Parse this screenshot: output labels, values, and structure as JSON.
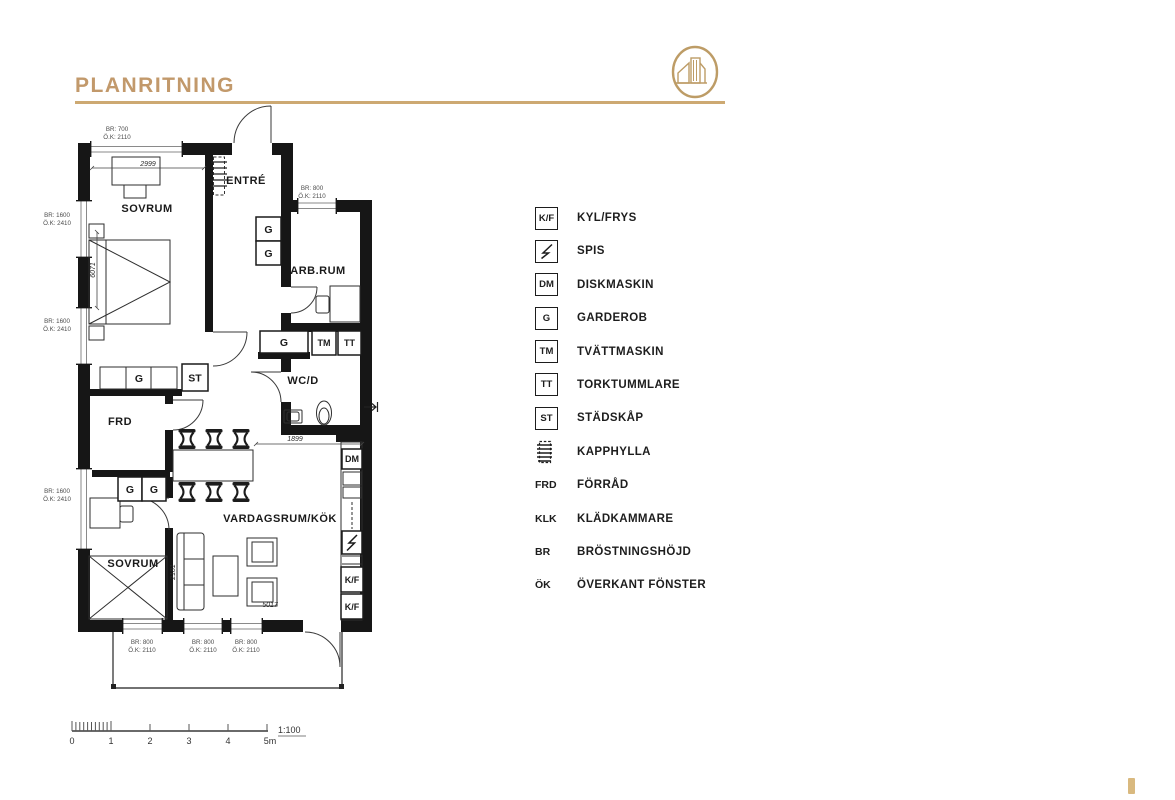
{
  "header": {
    "title": "PLANRITNING",
    "accent_color": "#C2996B",
    "rule_color": "#CDA972"
  },
  "floorplan": {
    "rooms": [
      {
        "id": "sovrum-1",
        "label": "SOVRUM"
      },
      {
        "id": "entre",
        "label": "ENTRÉ"
      },
      {
        "id": "arbrum",
        "label": "ARB.RUM"
      },
      {
        "id": "wcd",
        "label": "WC/D"
      },
      {
        "id": "frd",
        "label": "FRD"
      },
      {
        "id": "sovrum-2",
        "label": "SOVRUM"
      },
      {
        "id": "vardagsrum-kok",
        "label": "VARDAGSRUM/KÖK"
      }
    ],
    "fixtures": {
      "hall_g_1": "G",
      "hall_g_2": "G",
      "stadskap": "ST",
      "wardrobe_g": "G",
      "wc_g": "G",
      "tvattmaskin": "TM",
      "torktumlare": "TT",
      "diskmaskin": "DM",
      "kyl_frys_1": "K/F",
      "kyl_frys_2": "K/F",
      "sovrum2_g_1": "G",
      "sovrum2_g_2": "G"
    },
    "dimensions": {
      "top_width": "2999",
      "left_height": "6071",
      "wc_width": "1899",
      "sofa_depth": "2181",
      "bottom_width": "5017"
    },
    "window_labels": [
      {
        "id": "top",
        "br": "BR: 700",
        "ok": "Ö.K: 2110"
      },
      {
        "id": "arbrum",
        "br": "BR: 800",
        "ok": "Ö.K: 2110"
      },
      {
        "id": "left-upper",
        "br": "BR: 1600",
        "ok": "Ö.K: 2410"
      },
      {
        "id": "left-middle",
        "br": "BR: 1600",
        "ok": "Ö.K: 2410"
      },
      {
        "id": "left-lower",
        "br": "BR: 1600",
        "ok": "Ö.K: 2410"
      },
      {
        "id": "bottom-left",
        "br": "BR: 800",
        "ok": "Ö.K: 2110"
      },
      {
        "id": "bottom-middle",
        "br": "BR: 800",
        "ok": "Ö.K: 2110"
      },
      {
        "id": "bottom-right",
        "br": "BR: 800",
        "ok": "Ö.K: 2110"
      }
    ]
  },
  "legend": {
    "items": [
      {
        "symbol": "K/F",
        "label": "KYL/FRYS",
        "kind": "box"
      },
      {
        "symbol": "",
        "label": "SPIS",
        "kind": "bolt"
      },
      {
        "symbol": "DM",
        "label": "DISKMASKIN",
        "kind": "box"
      },
      {
        "symbol": "G",
        "label": "GARDEROB",
        "kind": "box"
      },
      {
        "symbol": "TM",
        "label": "TVÄTTMASKIN",
        "kind": "box"
      },
      {
        "symbol": "TT",
        "label": "TORKTUMMLARE",
        "kind": "box"
      },
      {
        "symbol": "ST",
        "label": "STÄDSKÅP",
        "kind": "box"
      },
      {
        "symbol": "",
        "label": "KAPPHYLLA",
        "kind": "rack"
      },
      {
        "symbol": "FRD",
        "label": "FÖRRÅD",
        "kind": "text"
      },
      {
        "symbol": "KLK",
        "label": "KLÄDKAMMARE",
        "kind": "text"
      },
      {
        "symbol": "BR",
        "label": "BRÖSTNINGSHÖJD",
        "kind": "text"
      },
      {
        "symbol": "ÖK",
        "label": "ÖVERKANT FÖNSTER",
        "kind": "text"
      }
    ]
  },
  "scale_bar": {
    "ticks": [
      "0",
      "1",
      "2",
      "3",
      "4",
      "5m"
    ],
    "ratio": "1:100"
  }
}
